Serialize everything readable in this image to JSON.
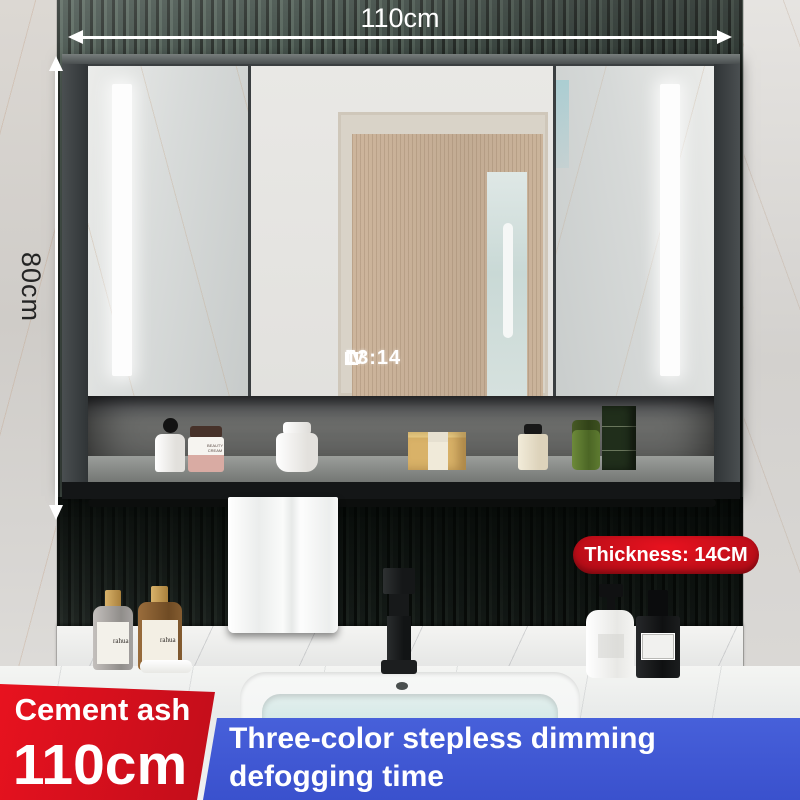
{
  "annotations": {
    "width_label": "110cm",
    "height_label": "80cm",
    "thickness_badge": "Thickness: 14CM"
  },
  "mirror_display": {
    "time": "13:14",
    "mode": "IV"
  },
  "info_panel": {
    "color_name": "Cement ash",
    "size": "110cm"
  },
  "feature_banner": {
    "line1": "Three-color stepless dimming",
    "line2": "defogging time"
  },
  "shelf": {
    "cream_jar_label": "BEAUTY CREAM"
  },
  "counter": {
    "left_bottle1_label": "rahua",
    "left_bottle2_label": "rahua"
  },
  "colors": {
    "accent_red": "#c00d1a",
    "accent_red_bright": "#e8121f",
    "accent_red_dark": "#a80b15",
    "banner_blue": "#3a51cd",
    "wall_green": "#33413a",
    "wall_green_dark": "#141b16",
    "arrow_white": "#ffffff",
    "dim_text_dark": "#242424"
  }
}
